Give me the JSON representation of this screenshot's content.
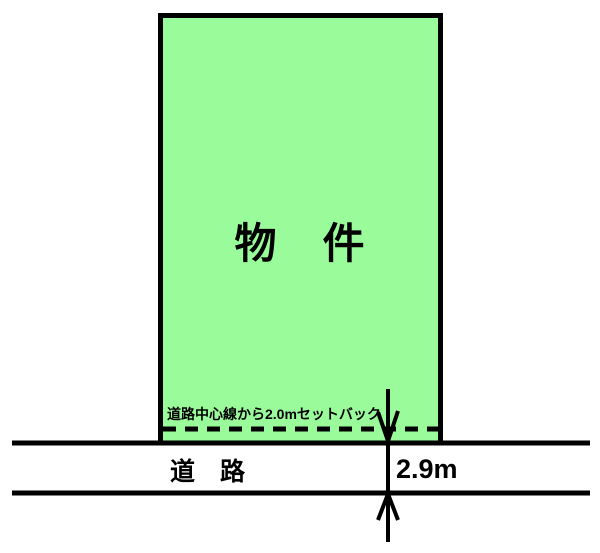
{
  "diagram": {
    "parcel": {
      "label": "物　件"
    },
    "setback": {
      "note": "道路中心線から2.0mセットバック",
      "distance": "2.0m"
    },
    "road": {
      "label": "道　路",
      "width_label": "2.9m"
    },
    "colors": {
      "parcel_fill": "#99FB99",
      "line": "#000000",
      "background": "#FFFFFF"
    }
  }
}
